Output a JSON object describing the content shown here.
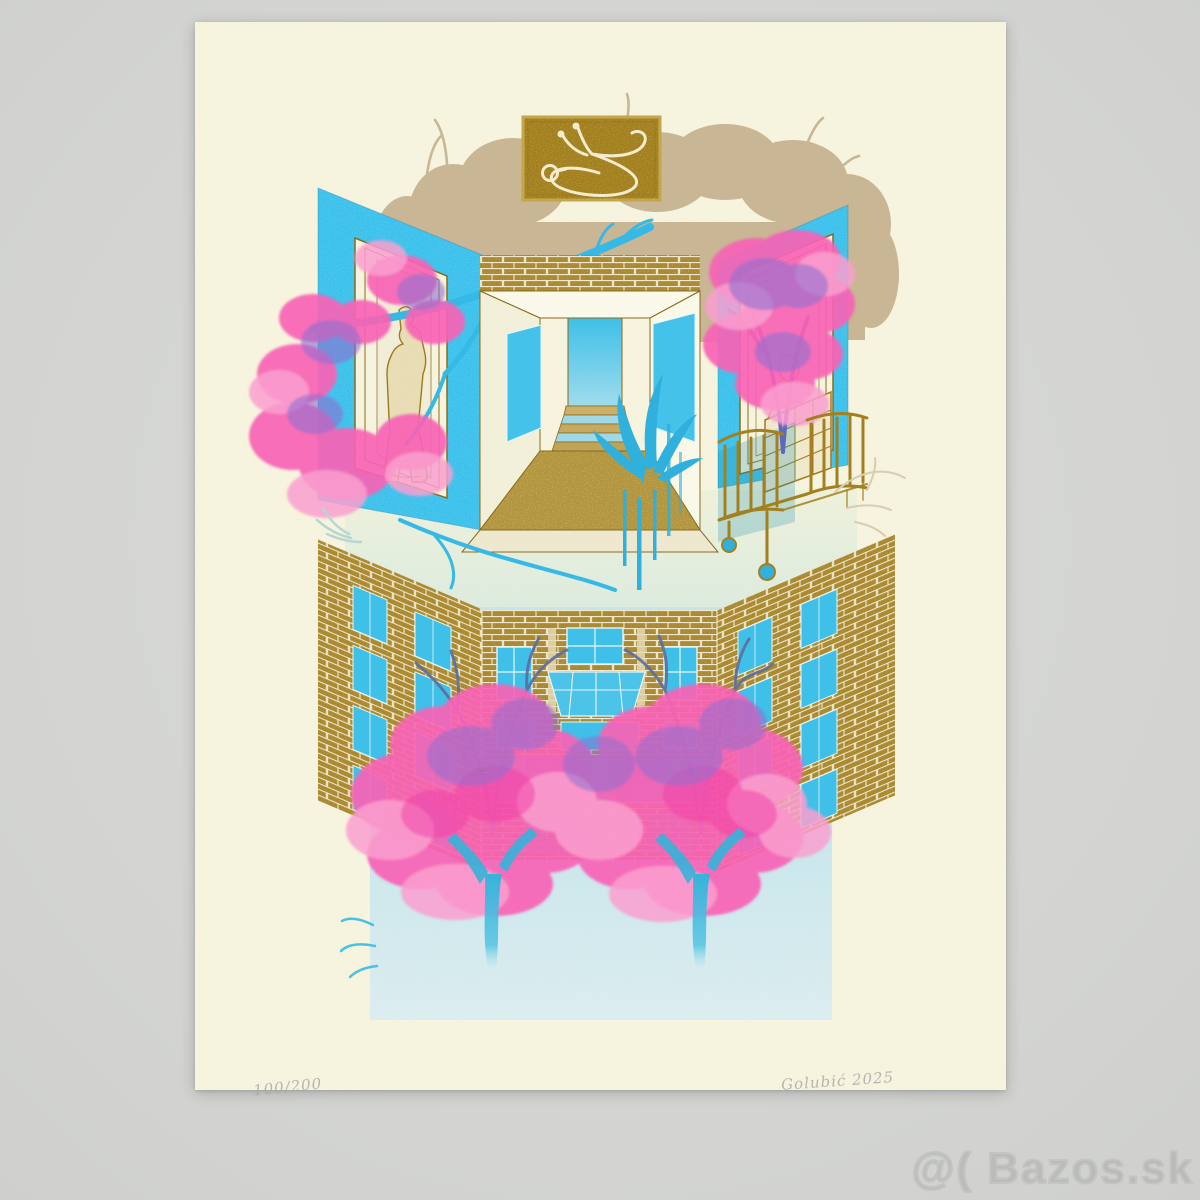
{
  "print": {
    "edition": "100/200",
    "signature": "Golubić 2025",
    "motifs": {
      "plaque_icon": "stethoscope",
      "upper_scene": "gallery-interior-with-statues-and-hospital-bed",
      "lower_scene": "brick-apartment-facade-with-blossom-trees-and-reflection"
    }
  },
  "watermark": {
    "text": "@( Bazos.sk"
  },
  "colors": {
    "background": "#d5d6d4",
    "paper": "#f6f4de",
    "plaque_gold": "#a3801e",
    "brick_gold": "#a9882e",
    "tan_silhouette": "#c9b695",
    "cyan_wall": "#3dc2ec",
    "branch_blue": "#2fb0dd",
    "pink": "#f963b6",
    "light_pink": "#fb9fd0",
    "magenta": "#f23fa6",
    "purple": "#8f6fd0",
    "slate_branch": "#5b6f9e",
    "field_blue": "#c9e7ec",
    "pencil_gray": "#a8aca9",
    "watermark_gray": "#c3c5c3"
  }
}
